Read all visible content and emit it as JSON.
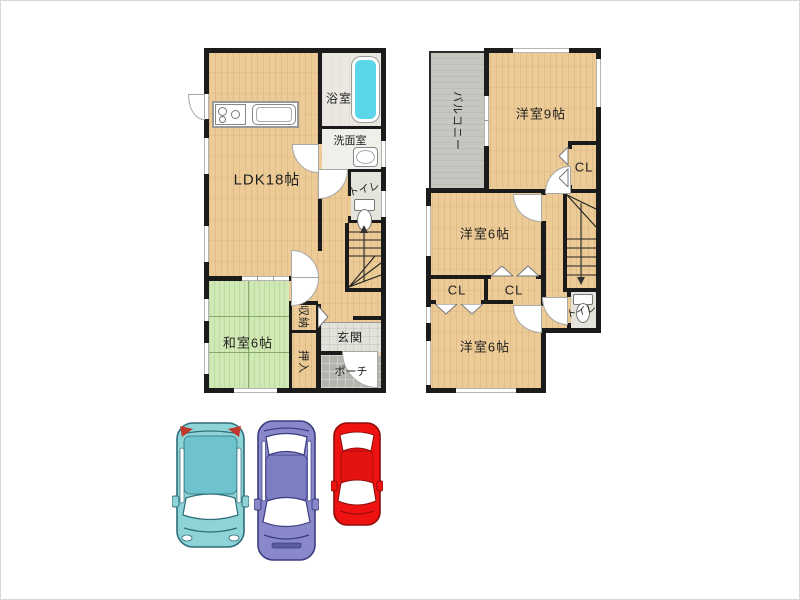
{
  "floor1": {
    "ldk": "LDK18帖",
    "bath": "浴室",
    "washroom": "洗面室",
    "toilet": "トイレ",
    "tatami_room": "和室6帖",
    "storage": "収納",
    "futon_closet": "押入",
    "entrance": "玄関",
    "porch": "ポーチ"
  },
  "floor2": {
    "balcony": "バルコニー",
    "western_9": "洋室9帖",
    "cl_top": "CL",
    "western_6_mid": "洋室6帖",
    "cl_left": "CL",
    "cl_right": "CL",
    "western_6_btm": "洋室6帖",
    "toilet": "トイレ"
  },
  "cars": [
    {
      "name": "teal-suv",
      "body": "#8ed4d6",
      "roof": "#6fc3cf",
      "stroke": "#2e6d7a"
    },
    {
      "name": "purple-sedan",
      "body": "#8888cb",
      "roof": "#7d7dc3",
      "stroke": "#3c3c80"
    },
    {
      "name": "red-sedan",
      "body": "#ee1310",
      "roof": "#e51310",
      "stroke": "#8d0d0d"
    }
  ],
  "colors": {
    "wall": "#1b1b1b",
    "wood_floor": "#eccb97",
    "tatami": "#cfe8b4",
    "balcony": "#c7c6c1",
    "bathtub": "#5ad6e8",
    "entrance_tile": "#e2e1da",
    "porch_tile": "#b5b4ae",
    "background": "#ffffff"
  }
}
